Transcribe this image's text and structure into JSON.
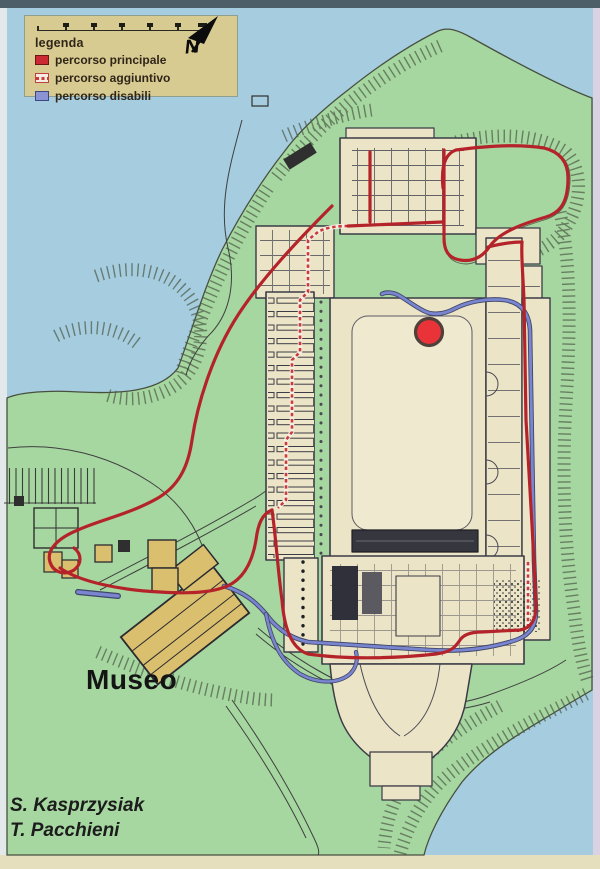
{
  "legend": {
    "title": "legenda",
    "items": [
      {
        "label": "percorso principale",
        "color": "#cc2a33",
        "style": "solid-red"
      },
      {
        "label": "percorso aggiuntivo",
        "color": "#cc3a3a",
        "style": "red-dashed-on-white"
      },
      {
        "label": "percorso disabili",
        "color": "#8a93d4",
        "style": "solid-blue"
      }
    ],
    "box_color": "#d8cb91"
  },
  "compass": {
    "label": "N"
  },
  "labels": {
    "museum": "Museo"
  },
  "credits": {
    "line1": "S. Kasprzysiak",
    "line2": "T. Pacchieni"
  },
  "marker": {
    "meaning": "you-are-here",
    "color": "#ea3338"
  },
  "map_colors": {
    "water": "#a5cddf",
    "land": "#a6d7a0",
    "complex": "#ece4c6",
    "museum_building": "#d9bf6e",
    "route_main": "#b5232a",
    "route_additional": "#cc3a3a",
    "route_accessible": "#7a85d0"
  }
}
